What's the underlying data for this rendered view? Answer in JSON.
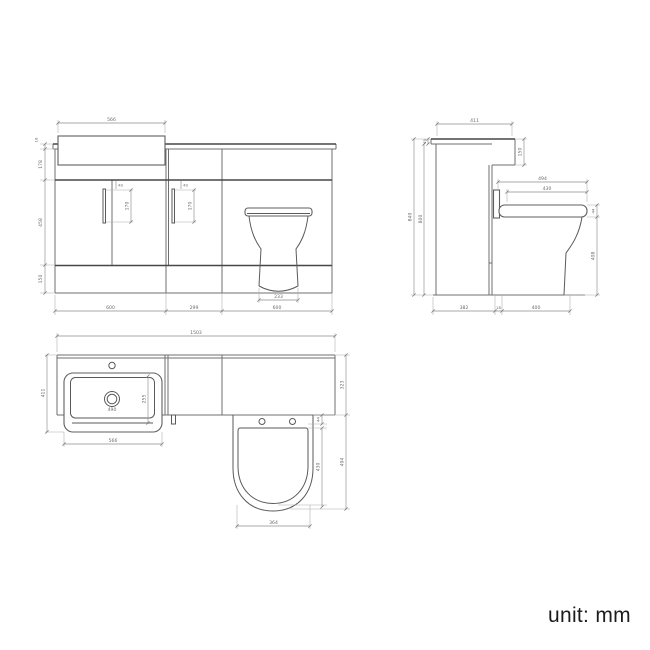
{
  "drawing": {
    "title": "bathroom-combination-unit-technical-drawing",
    "views": {
      "front": {
        "dims": {
          "basin_width": "566",
          "worktop_thickness": "18",
          "top_section_height": "178",
          "door_height": "458",
          "plinth_height": "150",
          "handle_offset": "40",
          "handle_length": "170",
          "vanity_unit_width": "600",
          "mid_unit_width": "299",
          "wc_unit_width": "600",
          "pan_base_width": "233"
        }
      },
      "side": {
        "dims": {
          "worktop_depth": "411",
          "worktop_edge_height": "45",
          "upstand_height": "150",
          "overall_height": "840",
          "carcass_height": "800",
          "pan_projection": "494",
          "seat_length": "430",
          "seat_thickness": "44",
          "pan_height": "408",
          "base_depth": "382",
          "gap": "18",
          "pan_depth": "400"
        }
      },
      "plan": {
        "dims": {
          "overall_width": "1503",
          "basin_depth": "411",
          "bowl_depth": "255",
          "bowl_width": "490",
          "basin_width": "566",
          "run_depth": "323",
          "seat_setback": "44",
          "seat_length": "430",
          "pan_projection": "494",
          "pan_width": "364"
        }
      }
    },
    "footer": {
      "unit_label": "unit: mm"
    }
  }
}
